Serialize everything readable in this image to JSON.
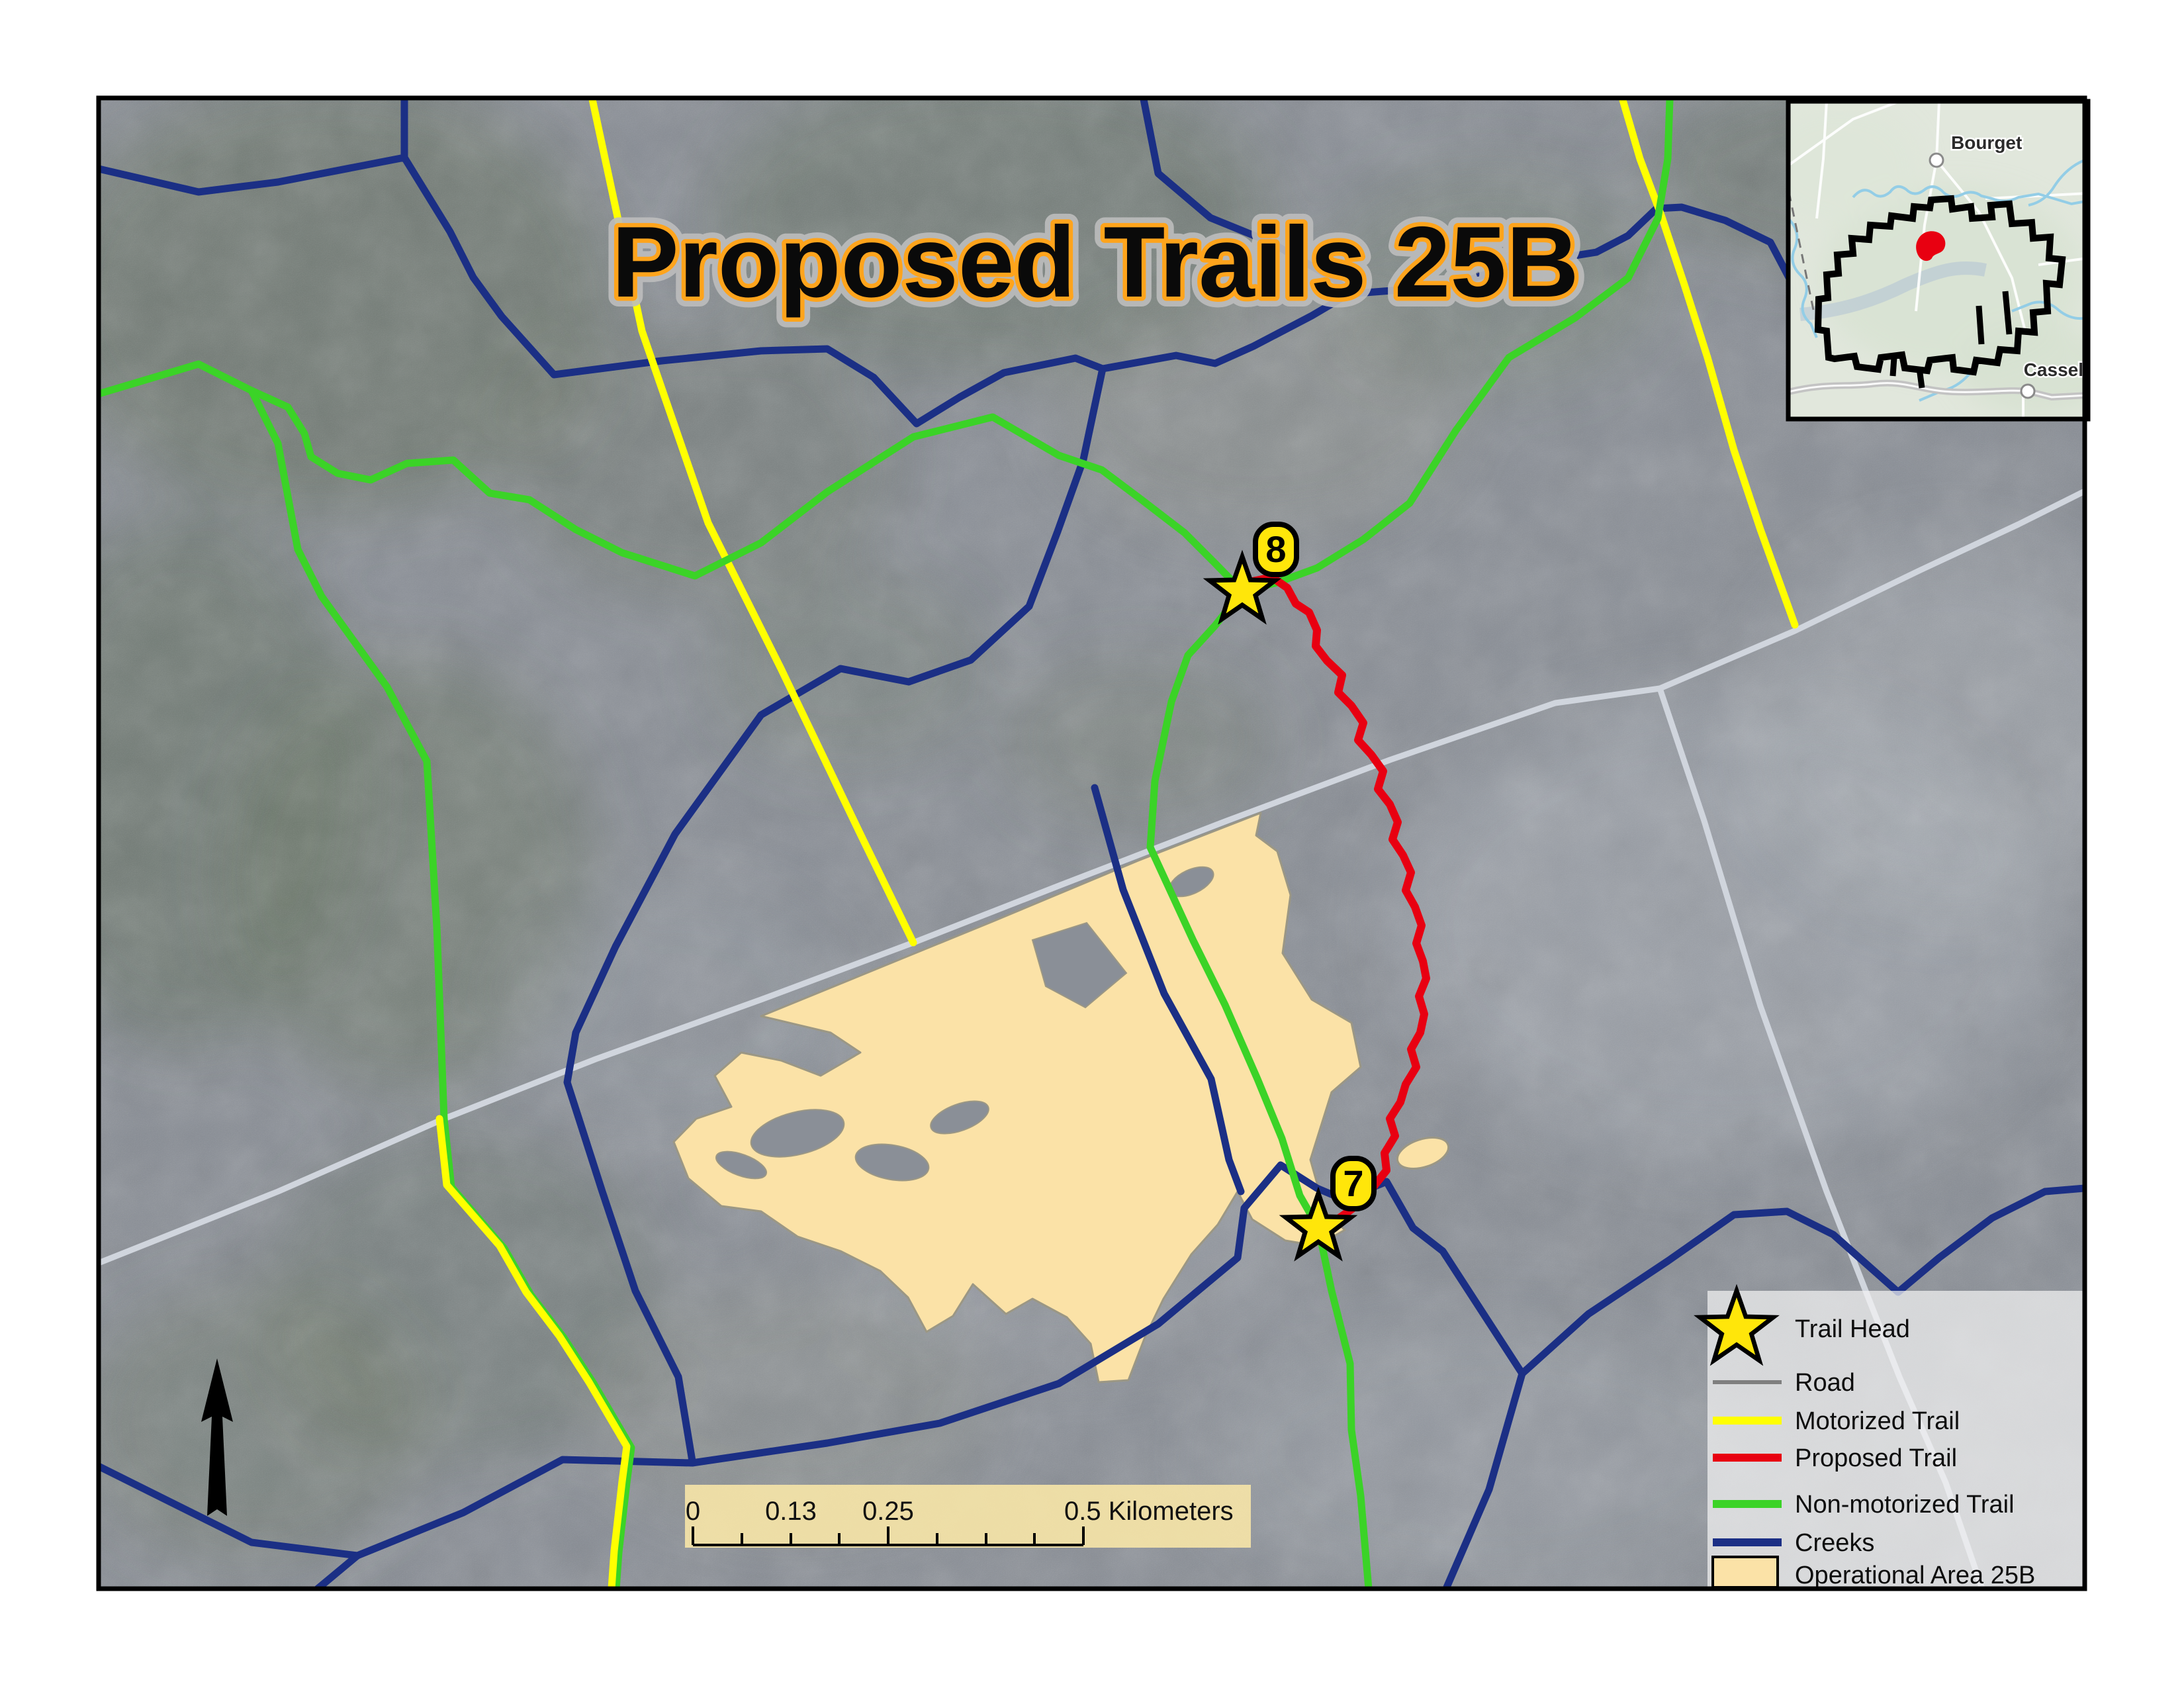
{
  "title": "Proposed Trails 25B",
  "map": {
    "trailheads": [
      {
        "number": "8"
      },
      {
        "number": "7"
      }
    ]
  },
  "inset": {
    "towns": [
      {
        "name": "Bourget"
      },
      {
        "name": "Cassel"
      }
    ],
    "highlight_color": "#e80011",
    "boundary_color": "#000000"
  },
  "legend": {
    "items": [
      {
        "label": "Trail Head",
        "symbol": "star",
        "color": "#ffe60a"
      },
      {
        "label": "Road",
        "symbol": "line",
        "color": "#7f7f7f"
      },
      {
        "label": "Motorized Trail",
        "symbol": "line",
        "color": "#ffff00"
      },
      {
        "label": "Proposed Trail",
        "symbol": "line",
        "color": "#e80011"
      },
      {
        "label": "Non-motorized Trail",
        "symbol": "line",
        "color": "#3bd327"
      },
      {
        "label": "Creeks",
        "symbol": "line",
        "color": "#1b2f85"
      },
      {
        "label": "Operational Area 25B",
        "symbol": "area",
        "color": "#fbe2a7"
      }
    ]
  },
  "scalebar": {
    "labels": [
      "0",
      "0.13",
      "0.25"
    ],
    "end_label": "0.5 Kilometers"
  },
  "colors": {
    "title_fill": "#0a0a0a",
    "title_outline": "#ffa41c",
    "road": "#d0d5dd",
    "motorized_trail": "#ffff00",
    "proposed_trail": "#e80011",
    "non_motorized_trail": "#3bd327",
    "creek": "#1b2f85",
    "operational_area": "#fbe2a7",
    "trailhead_star": "#ffe60a"
  }
}
